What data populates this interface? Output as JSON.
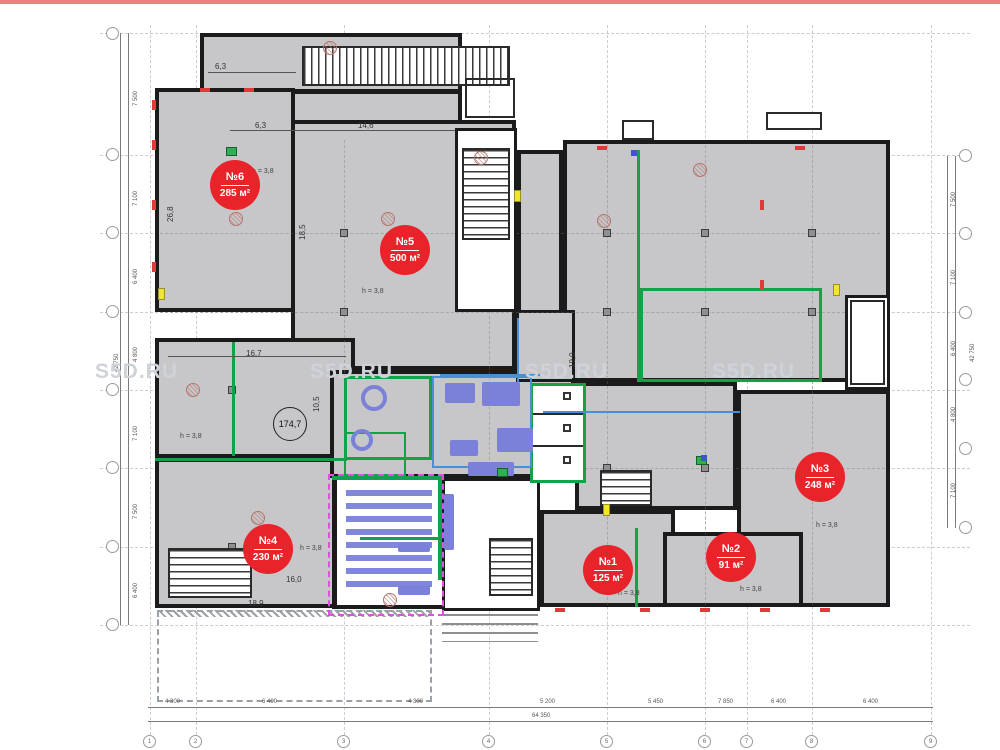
{
  "page": {
    "watermark": "S5D.RU",
    "top_bar_color": "#ee8180"
  },
  "units": [
    {
      "number": "№1",
      "area": "125 м²"
    },
    {
      "number": "№2",
      "area": "91 м²"
    },
    {
      "number": "№3",
      "area": "248 м²"
    },
    {
      "number": "№4",
      "area": "230 м²"
    },
    {
      "number": "№5",
      "area": "500 м²"
    },
    {
      "number": "№6",
      "area": "285 м²"
    }
  ],
  "h_note": "h = 3,8",
  "area_circle": {
    "value": "174,7"
  },
  "dims": {
    "d63a": "6,3",
    "d63b": "6,3",
    "d146": "14,6",
    "d167": "16,7",
    "d105": "10,5",
    "d160": "16,0",
    "d189": "18,9",
    "d190": "19,0",
    "d185": "18,5",
    "d268": "26,8"
  },
  "axes": {
    "bottom": {
      "segments": [
        "4 300",
        "6 400",
        "4 300",
        "5 200",
        "5 450",
        "7 850",
        "6 400",
        "6 400"
      ],
      "total": "64 350",
      "bubbles": [
        "1",
        "2",
        "3",
        "4",
        "5",
        "6",
        "7",
        "8",
        "9"
      ]
    },
    "left": {
      "segments": [
        "7 500",
        "7 100",
        "6 400",
        "4 800",
        "7 100",
        "7 500",
        "6 400"
      ],
      "total": "42 750"
    },
    "right": {
      "segments": [
        "7 500",
        "7 100",
        "6 400",
        "4 800",
        "7 100"
      ],
      "total": "42 750"
    }
  },
  "colors": {
    "badge_red": "#e8232a",
    "wall_black": "#1b1b1b",
    "room_gray": "#c7c7c9",
    "partition_green": "#13a24a",
    "glazing_blue": "#4a8fd3",
    "furniture_purple": "#7b80d8",
    "zone_magenta": "#e04fdf",
    "alarm_red": "#e03b3b",
    "marker_yellow": "#f2e52e",
    "watermark_gray": "#ced2d9"
  }
}
